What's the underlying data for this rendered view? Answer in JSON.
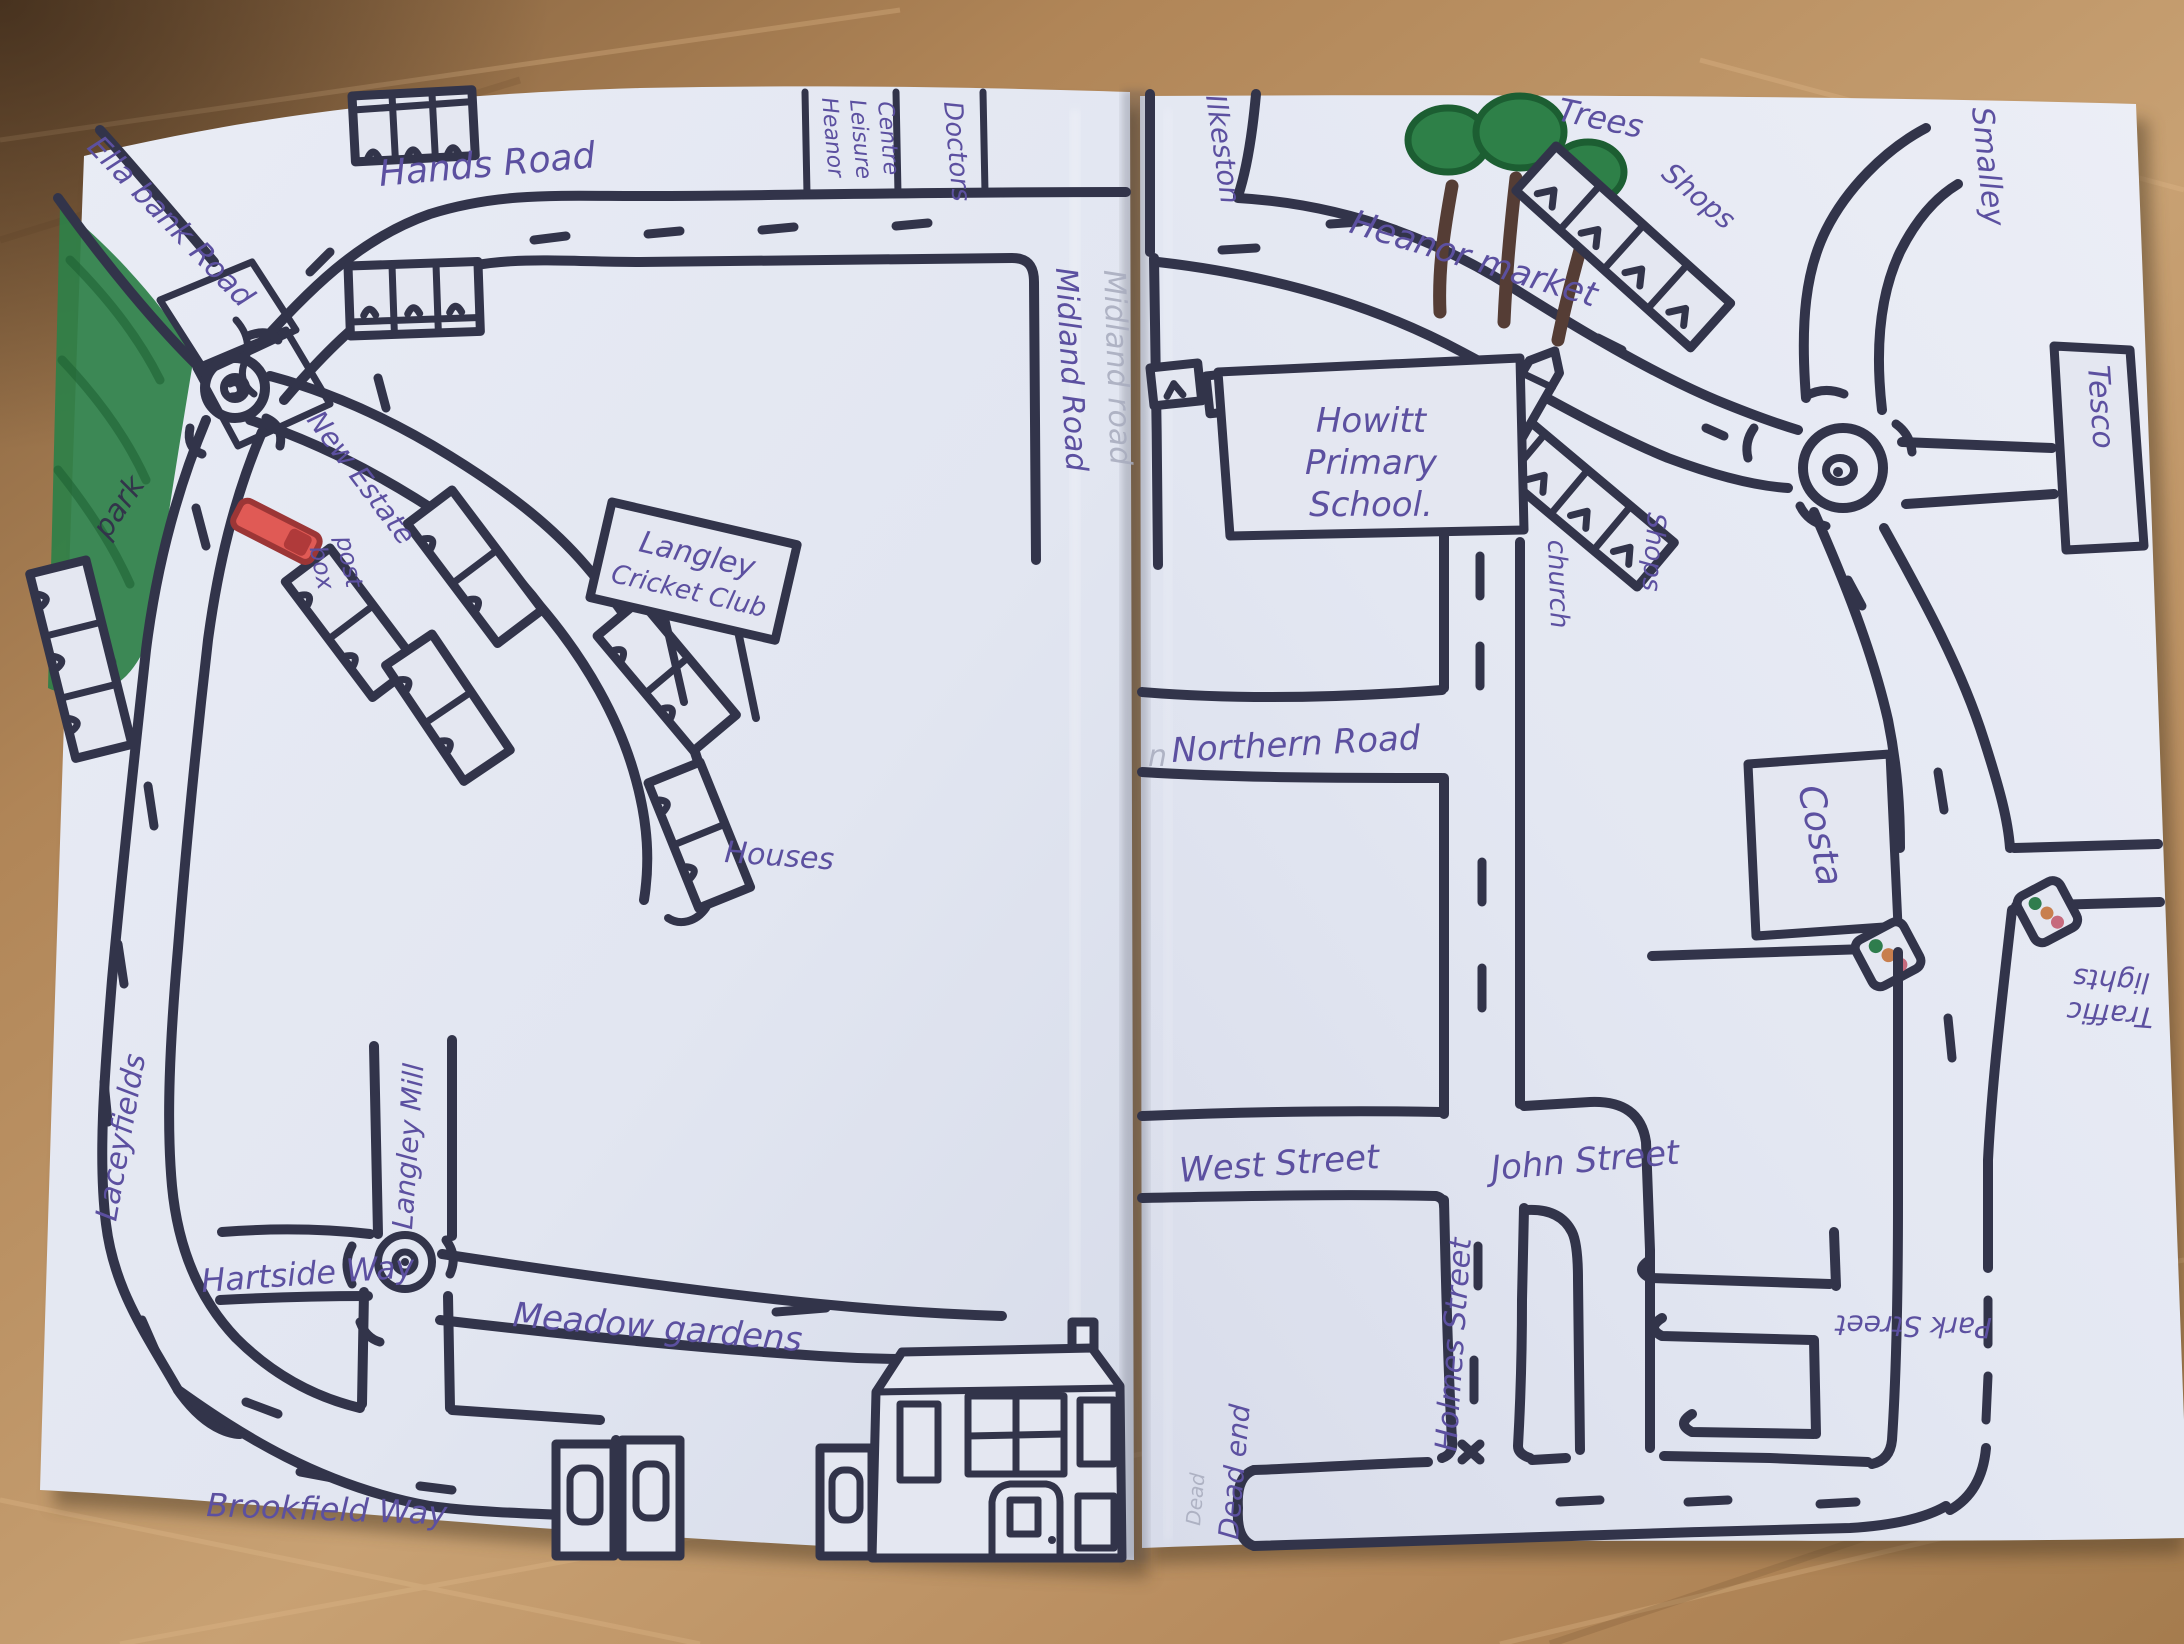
{
  "scene": {
    "description": "Child's hand-drawn street map of Langley and Heanor across two sheets of paper photographed on a wooden table"
  },
  "colors": {
    "ink": "#32344a",
    "purple": "#5c50a0",
    "pencil": "#a7abbd",
    "paper": "#e4e7f1",
    "wood": "#b68a5c",
    "green-dark": "#1c5e32",
    "green": "#2e8048",
    "red-postbox": "#e05a55",
    "light-green": "#2f7d4d",
    "light-amber": "#c87f4e",
    "light-red": "#c66a7d",
    "trunk": "#553d35"
  },
  "left_page": {
    "labels": {
      "ella_bank_road": "Ella bank Road",
      "park": "park",
      "hands_road": "Hands Road",
      "leisure_1": "Heanor",
      "leisure_2": "Leisure",
      "leisure_3": "Centre",
      "doctors": "Doctors",
      "midland_road": "Midland Road",
      "midland_road_pencil": "Midland road",
      "new_estate": "New Estate",
      "post_box_1": "post",
      "post_box_2": "box",
      "cricket_1": "Langley",
      "cricket_2": "Cricket Club",
      "houses": "Houses",
      "laceyfields": "Laceyfields",
      "hartside_way": "Hartside Way",
      "langley_mill": "Langley Mill",
      "meadow_gardens": "Meadow gardens",
      "brookfield_way": "Brookfield Way"
    }
  },
  "right_page": {
    "labels": {
      "ilkeston": "Ilkeston",
      "heanor_market": "Heanor market",
      "trees": "Trees",
      "shops_upper": "Shops",
      "smalley": "Smalley",
      "tesco": "Tesco",
      "howitt_1": "Howitt",
      "howitt_2": "Primary",
      "howitt_3": "School.",
      "church": "church",
      "shops_lower": "Shops",
      "northern_road": "Northern Road",
      "northern_road_pencil": "n",
      "costa": "Costa",
      "traffic_1": "Traffic",
      "traffic_2": "lights",
      "west_street": "West Street",
      "john_street": "John Street",
      "holmes_street": "Holmes Street",
      "park_street": "Park Street",
      "dead_end": "Dead end",
      "dead_end_pencil": "Dead"
    }
  }
}
